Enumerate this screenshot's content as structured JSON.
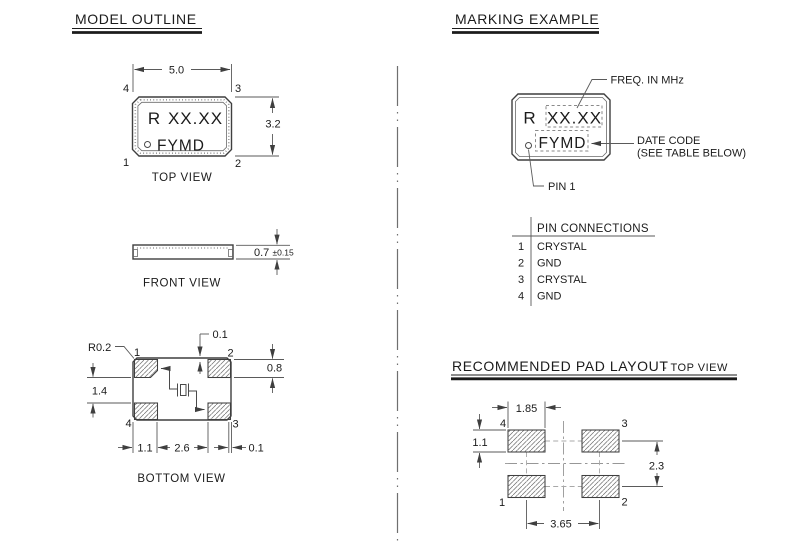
{
  "colors": {
    "background": "#ffffff",
    "line": "#3f3f3f",
    "dimension_line": "#5a5a5a",
    "text": "#1b1b1b"
  },
  "model_outline": {
    "title": "MODEL OUTLINE",
    "top_view": {
      "caption": "TOP VIEW",
      "width_dim": "5.0",
      "height_dim": "3.2",
      "pin_top_left": "4",
      "pin_top_right": "3",
      "pin_bottom_left": "1",
      "pin_bottom_right": "2",
      "marking_prefix": "R",
      "marking_freq": "XX.XX",
      "marking_datecode": "FYMD"
    },
    "front_view": {
      "caption": "FRONT VIEW",
      "thickness_dim": "0.7",
      "thickness_tol": "±0.15"
    },
    "bottom_view": {
      "caption": "BOTTOM VIEW",
      "corner_radius": "R0.2",
      "pad_edge_offset_top": "0.1",
      "pad_height": "0.8",
      "pad_vertical_gap": "1.4",
      "pad_width_dim": "1.1",
      "pad_inner_span": "2.6",
      "pad_edge_offset_right": "0.1",
      "pin_top_left": "1",
      "pin_top_right": "2",
      "pin_bottom_left": "4",
      "pin_bottom_right": "3"
    }
  },
  "marking_example": {
    "title": "MARKING EXAMPLE",
    "marking_prefix": "R",
    "marking_freq": "XX.XX",
    "marking_datecode": "FYMD",
    "callout_freq": "FREQ. IN MHz",
    "callout_datecode_line1": "DATE CODE",
    "callout_datecode_line2": "(SEE TABLE BELOW)",
    "callout_pin1": "PIN 1"
  },
  "pin_connections": {
    "header": "PIN CONNECTIONS",
    "rows": [
      {
        "pin": "1",
        "connection": "CRYSTAL"
      },
      {
        "pin": "2",
        "connection": "GND"
      },
      {
        "pin": "3",
        "connection": "CRYSTAL"
      },
      {
        "pin": "4",
        "connection": "GND"
      }
    ]
  },
  "pad_layout": {
    "title": "RECOMMENDED PAD LAYOUT",
    "title_suffix": "- TOP VIEW",
    "pad_width": "1.85",
    "pad_height": "1.1",
    "row_pitch": "2.3",
    "column_pitch": "3.65",
    "pin_top_left": "4",
    "pin_top_right": "3",
    "pin_bottom_left": "1",
    "pin_bottom_right": "2"
  }
}
